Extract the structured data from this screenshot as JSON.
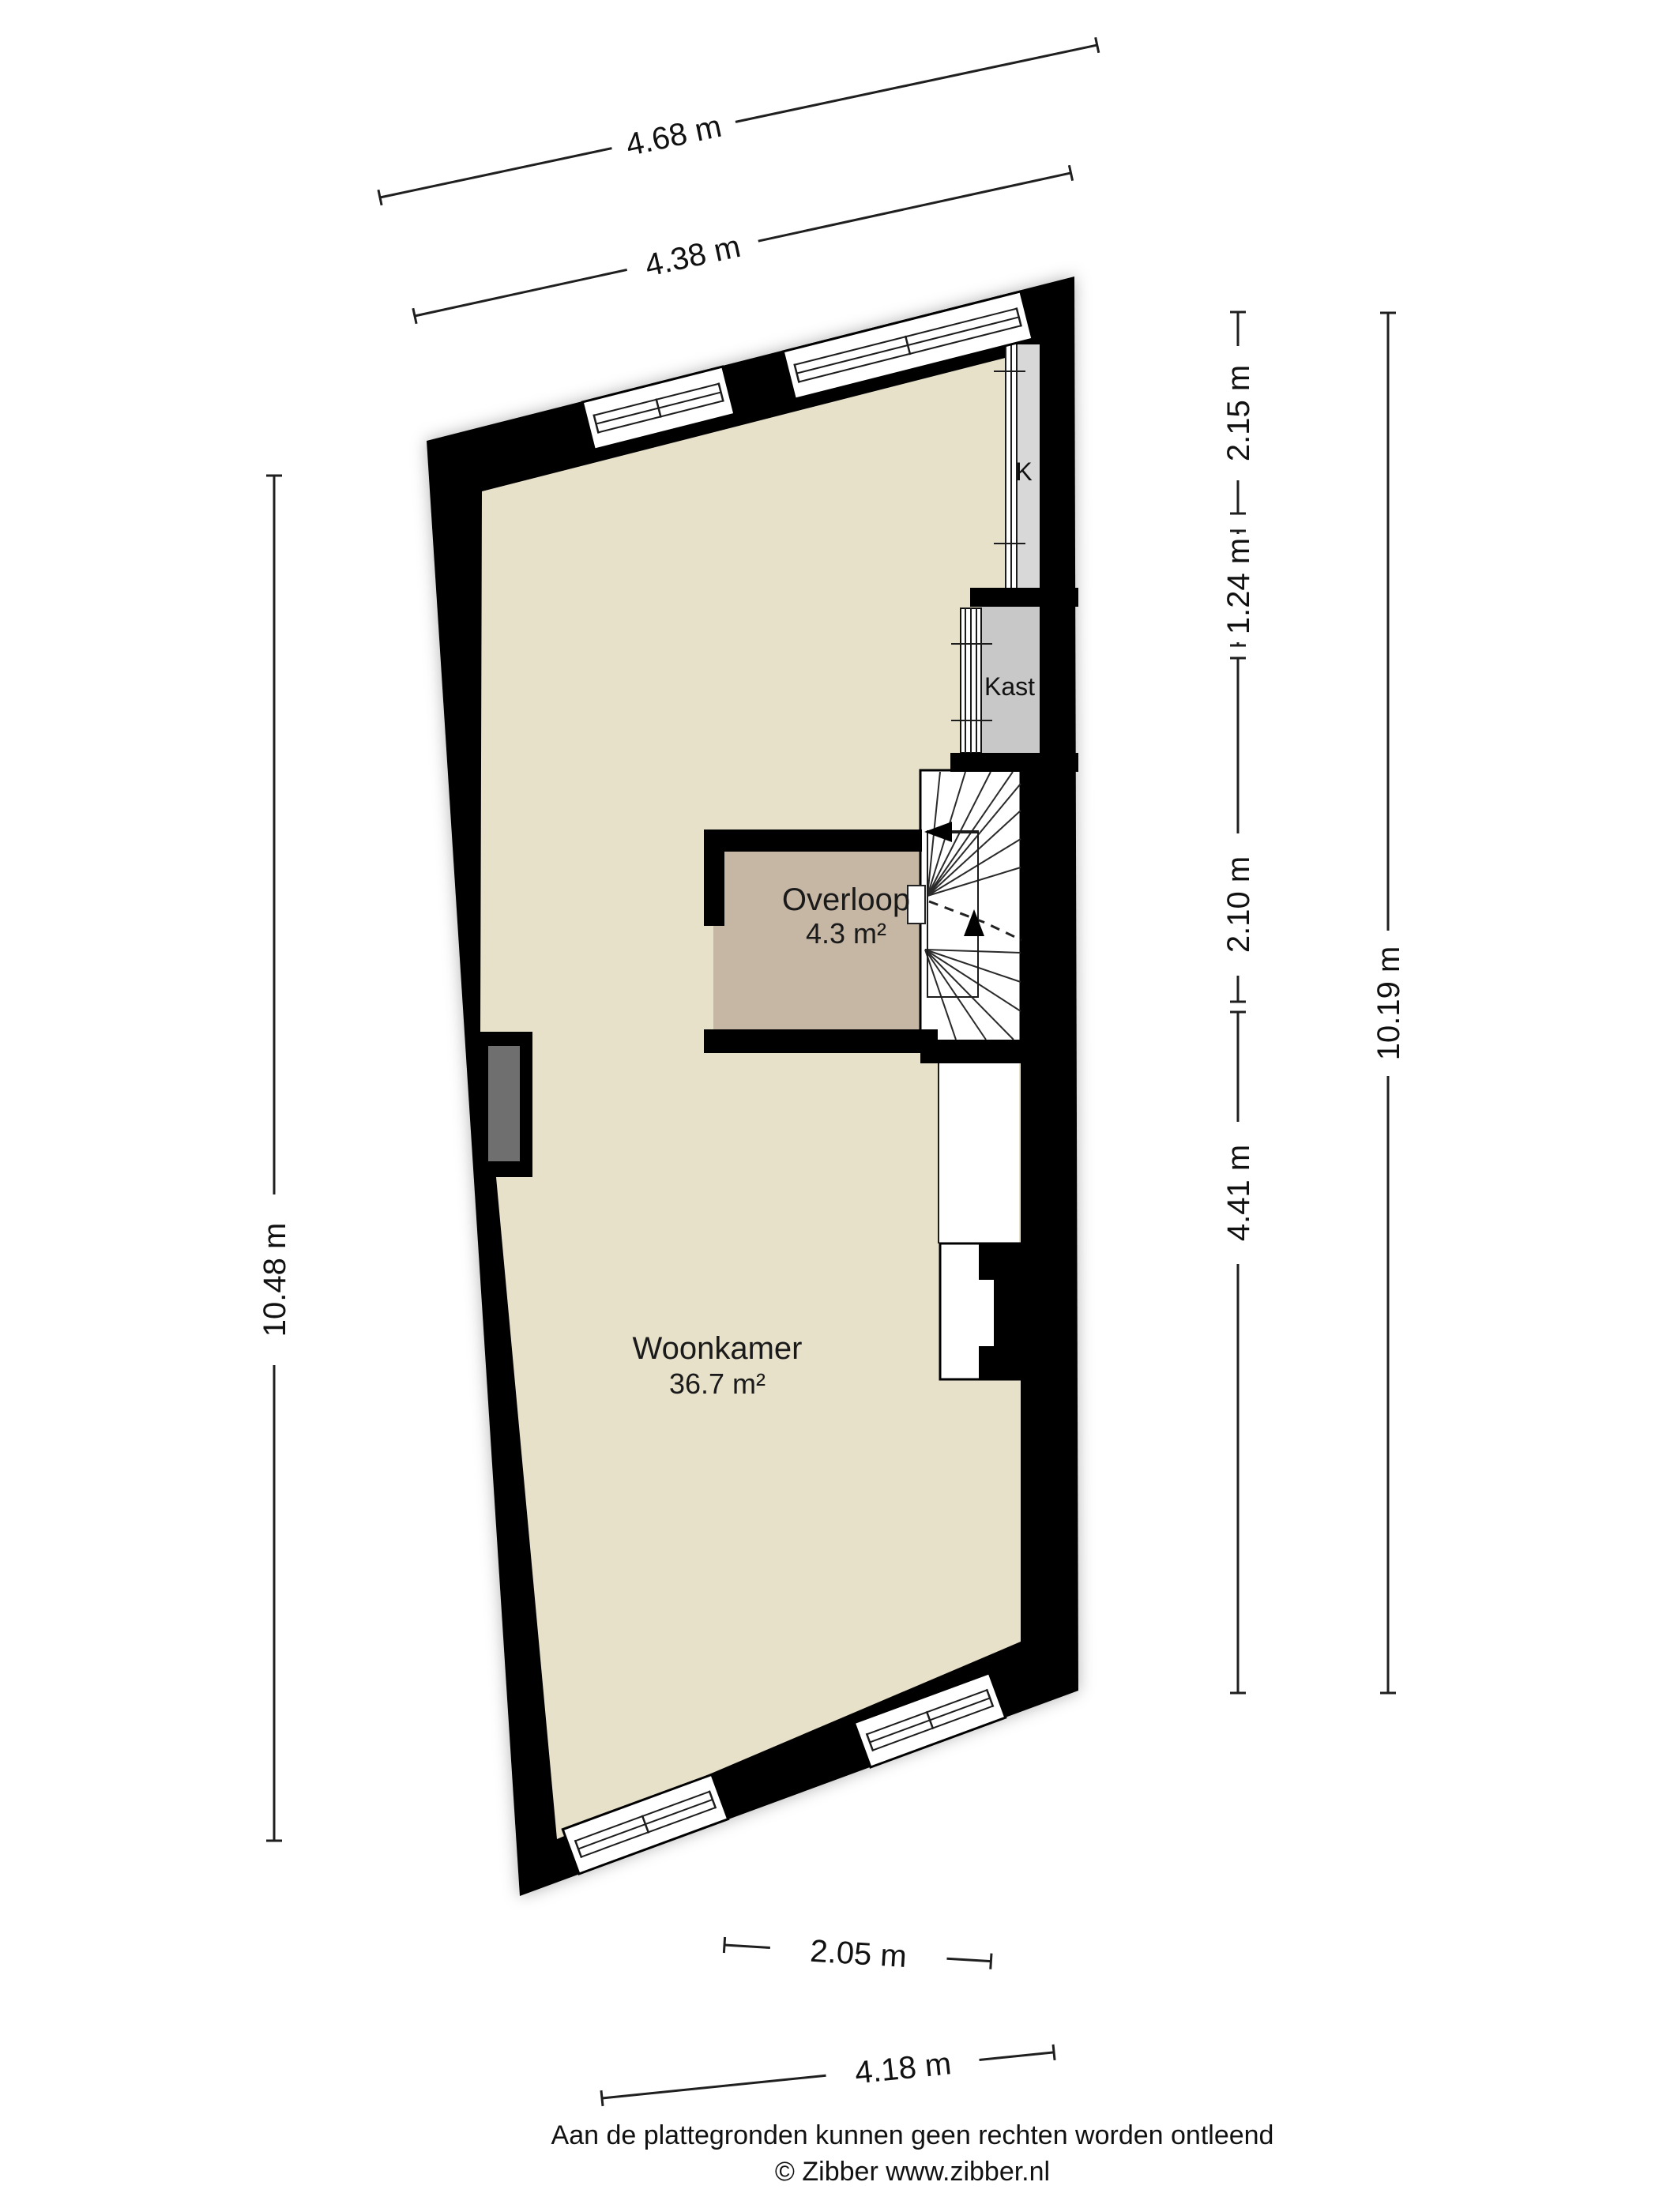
{
  "title": "Plattegrond verdieping",
  "rooms": {
    "woonkamer": {
      "name": "Woonkamer",
      "area": "36.7 m²"
    },
    "overloop": {
      "name": "Overloop",
      "area": "4.3 m²"
    },
    "kast": {
      "label": "Kast"
    },
    "k_shaft": {
      "label": "K"
    }
  },
  "dims": {
    "top_outer": "4.68 m",
    "top_inner": "4.38 m",
    "left": "10.48 m",
    "right_segments": [
      "2.15 m",
      "1.24 m",
      "2.10 m",
      "4.41 m"
    ],
    "right_total": "10.19 m",
    "bottom_inner": "2.05 m",
    "bottom_outer": "4.18 m"
  },
  "footer": {
    "line1": "Aan de plattegronden kunnen geen rechten worden ontleend",
    "line2": "© Zibber www.zibber.nl"
  },
  "colors": {
    "wall": "#000000",
    "floor": "#e8e1ca",
    "overloop": "#c6b7a5",
    "kast": "#c8c8c8",
    "k_shaft": "#d8d8d8",
    "niche": "#6f6f6f",
    "dim": "#1f1f1f"
  }
}
